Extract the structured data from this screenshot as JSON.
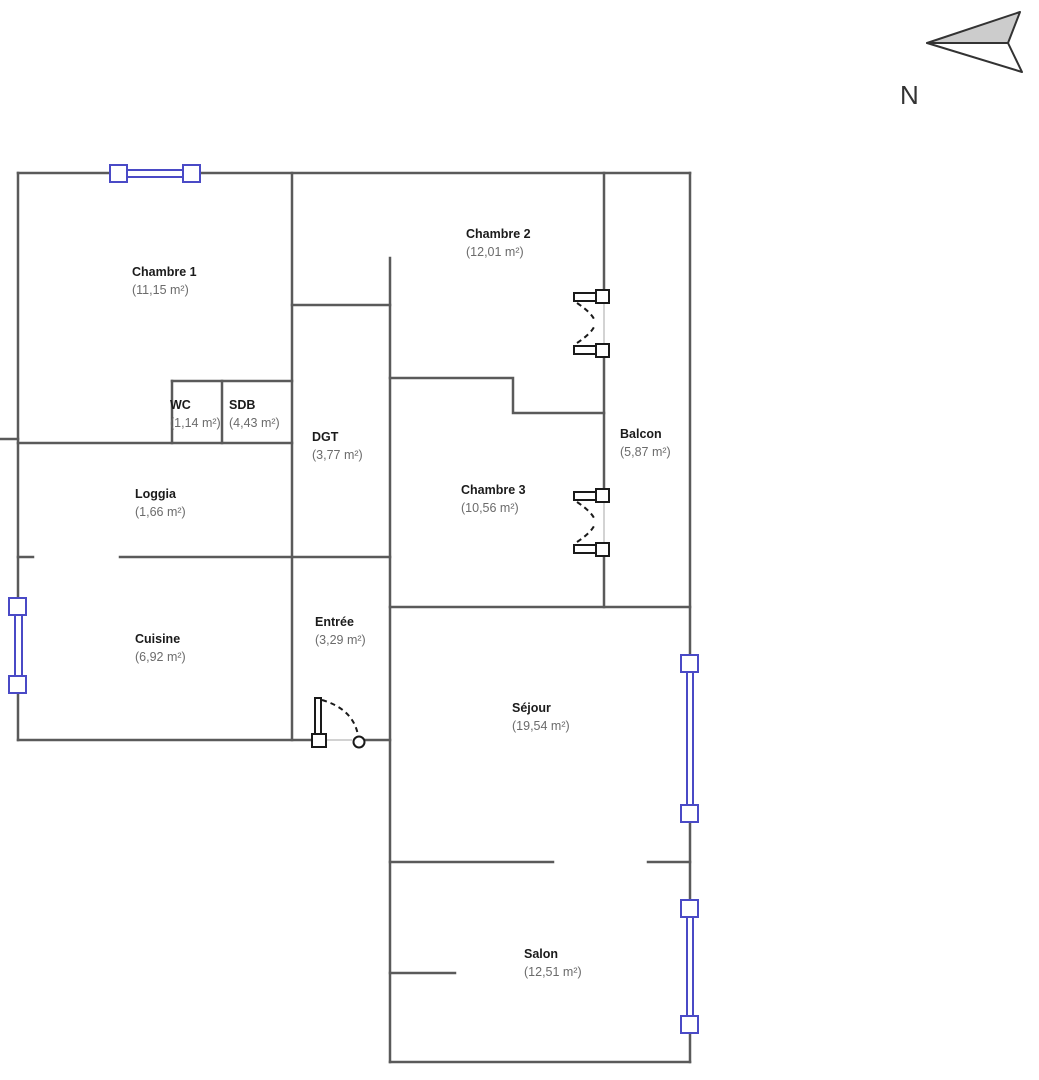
{
  "title": "Plan d'appartement",
  "compass": {
    "label": "N"
  },
  "colors": {
    "wall": "#5a5a5a",
    "window": "#4a4ac6",
    "door": "#1a1a1a",
    "threshold": "#c4c4c4",
    "north_fill": "#cccccc",
    "north_stroke": "#333333"
  },
  "rooms": [
    {
      "id": "chambre-1",
      "name": "Chambre 1",
      "area": "(11,15 m²)"
    },
    {
      "id": "chambre-2",
      "name": "Chambre 2",
      "area": "(12,01 m²)"
    },
    {
      "id": "wc",
      "name": "WC",
      "area": "(1,14 m²)"
    },
    {
      "id": "sdb",
      "name": "SDB",
      "area": "(4,43 m²)"
    },
    {
      "id": "dgt",
      "name": "DGT",
      "area": "(3,77 m²)"
    },
    {
      "id": "loggia",
      "name": "Loggia",
      "area": "(1,66 m²)"
    },
    {
      "id": "balcon",
      "name": "Balcon",
      "area": "(5,87 m²)"
    },
    {
      "id": "chambre-3",
      "name": "Chambre 3",
      "area": "(10,56 m²)"
    },
    {
      "id": "cuisine",
      "name": "Cuisine",
      "area": "(6,92 m²)"
    },
    {
      "id": "entree",
      "name": "Entrée",
      "area": "(3,29 m²)"
    },
    {
      "id": "sejour",
      "name": "Séjour",
      "area": "(19,54 m²)"
    },
    {
      "id": "salon",
      "name": "Salon",
      "area": "(12,51 m²)"
    }
  ]
}
